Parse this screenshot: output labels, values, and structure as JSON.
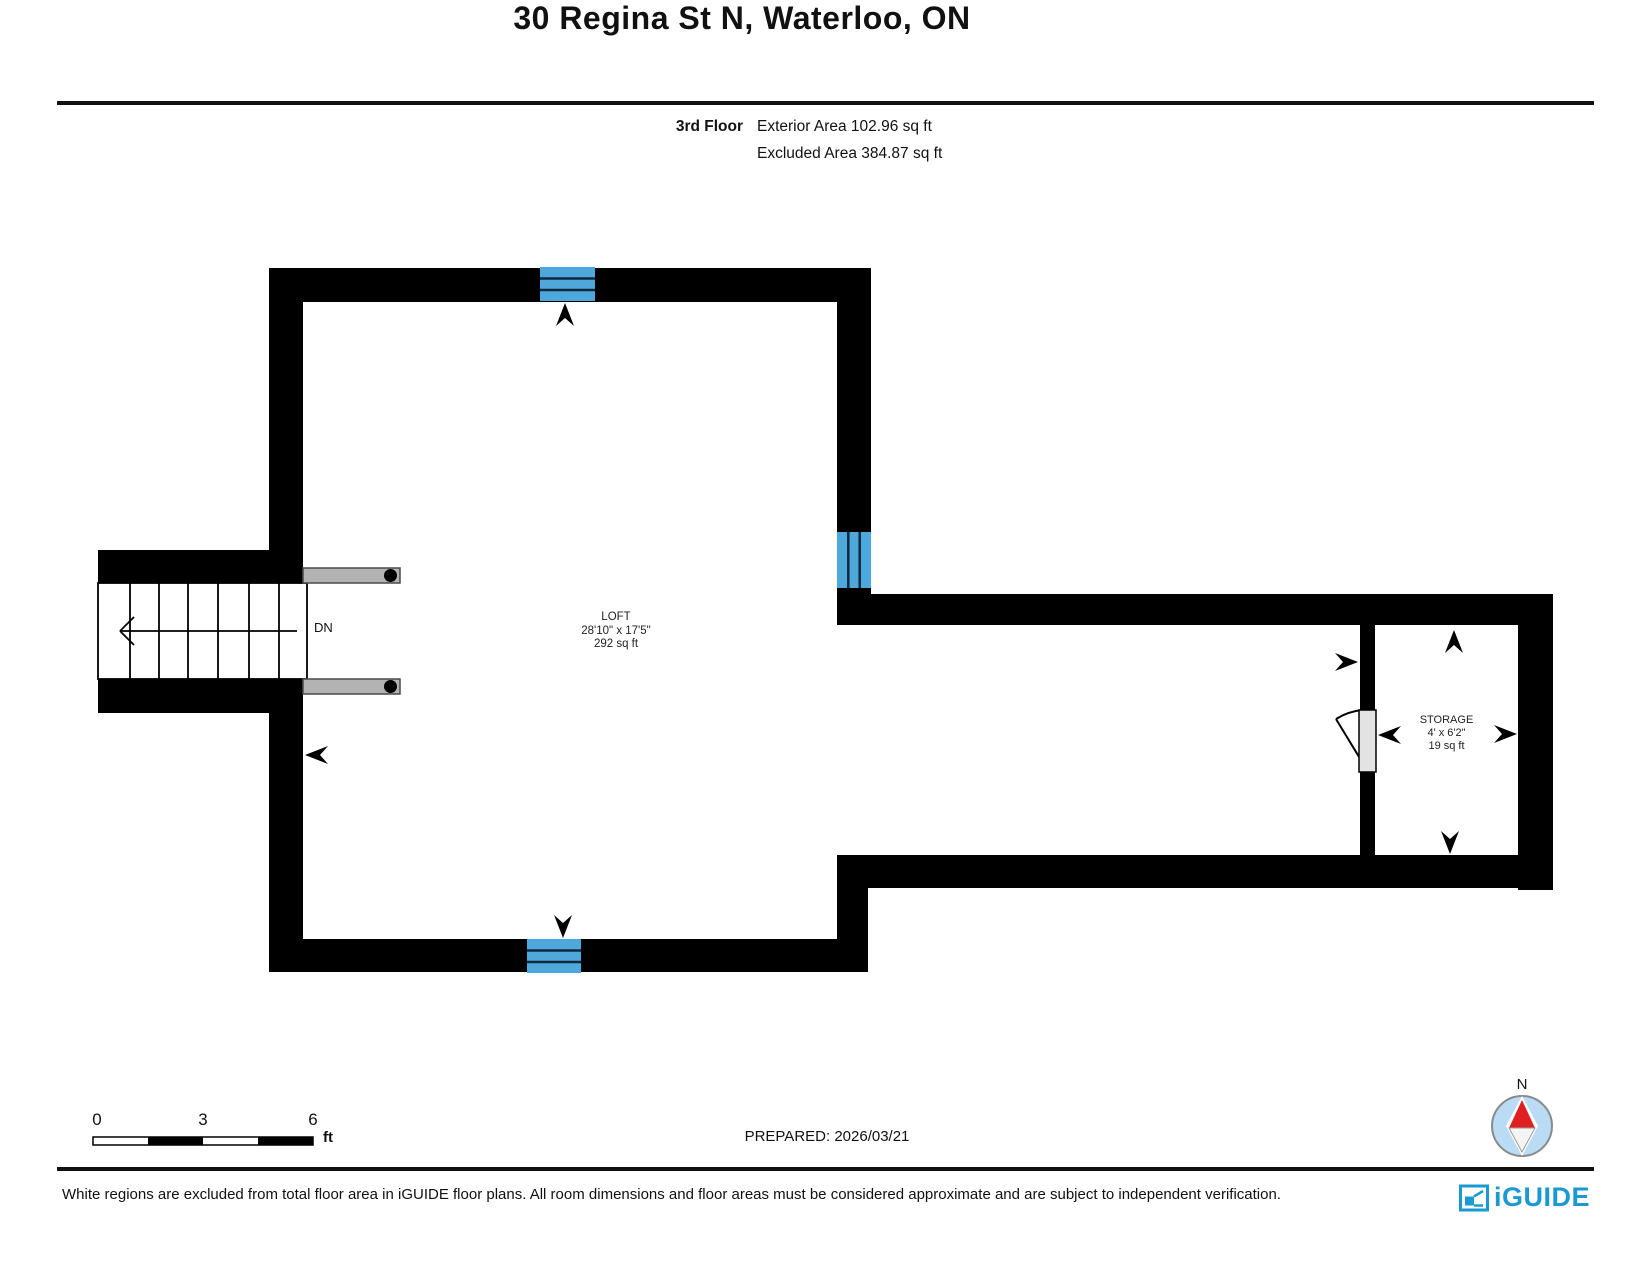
{
  "header": {
    "title": "30 Regina St N, Waterloo, ON",
    "floor_label": "3rd Floor",
    "exterior_area": "Exterior Area 102.96 sq ft",
    "excluded_area": "Excluded Area 384.87 sq ft"
  },
  "plan": {
    "rooms": [
      {
        "name": "LOFT",
        "dimensions": "28'10\" x 17'5\"",
        "area": "292 sq ft"
      },
      {
        "name": "STORAGE",
        "dimensions": "4' x 6'2\"",
        "area": "19 sq ft"
      }
    ],
    "stairs_label": "DN",
    "colors": {
      "wall": "#000000",
      "window": "#4FA8DC",
      "railing": "#b3b3b3",
      "door": "#e3e3e3"
    }
  },
  "scale_bar": {
    "tick0": "0",
    "tick3": "3",
    "tick6": "6",
    "unit": "ft"
  },
  "prepared": "PREPARED: 2026/03/21",
  "compass": {
    "north_label": "N"
  },
  "footer": {
    "disclaimer": "White regions are excluded from total floor area in iGUIDE floor plans. All room dimensions and floor areas must be considered approximate and are subject to independent verification.",
    "brand": "iGUIDE",
    "brand_color": "#1b9ad2"
  }
}
